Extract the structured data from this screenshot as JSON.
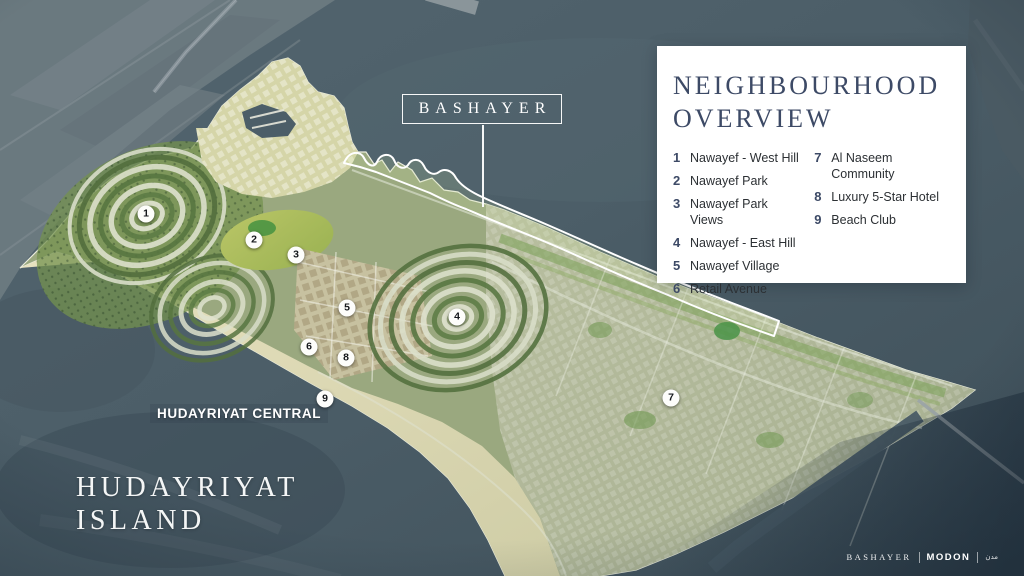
{
  "callout": {
    "label": "BASHAYER"
  },
  "legend": {
    "title_line1": "NEIGHBOURHOOD",
    "title_line2": "OVERVIEW",
    "items_left": [
      {
        "num": "1",
        "label": "Nawayef - West Hill"
      },
      {
        "num": "2",
        "label": "Nawayef Park"
      },
      {
        "num": "3",
        "label": "Nawayef Park Views"
      },
      {
        "num": "4",
        "label": "Nawayef - East Hill"
      },
      {
        "num": "5",
        "label": "Nawayef Village"
      },
      {
        "num": "6",
        "label": "Retail Avenue"
      }
    ],
    "items_right": [
      {
        "num": "7",
        "label": "Al Naseem\nCommunity"
      },
      {
        "num": "8",
        "label": "Luxury 5-Star Hotel"
      },
      {
        "num": "9",
        "label": "Beach Club"
      }
    ]
  },
  "map_labels": {
    "district": "HUDAYRIYAT CENTRAL",
    "island_line1": "HUDAYRIYAT",
    "island_line2": "ISLAND"
  },
  "markers": [
    {
      "num": "1",
      "x": 146,
      "y": 214
    },
    {
      "num": "2",
      "x": 254,
      "y": 240
    },
    {
      "num": "3",
      "x": 296,
      "y": 255
    },
    {
      "num": "4",
      "x": 457,
      "y": 317
    },
    {
      "num": "5",
      "x": 347,
      "y": 308
    },
    {
      "num": "6",
      "x": 309,
      "y": 347
    },
    {
      "num": "7",
      "x": 671,
      "y": 398
    },
    {
      "num": "8",
      "x": 346,
      "y": 358
    },
    {
      "num": "9",
      "x": 325,
      "y": 399
    }
  ],
  "footer": {
    "brand_primary": "BASHAYER",
    "brand_secondary": "MODON",
    "brand_mark": "مدن"
  },
  "colors": {
    "legend_accent": "#3d4a66",
    "legend_text": "#2c3034",
    "panel_bg": "#ffffff",
    "label_white": "#f4f6f6",
    "water": "#4c5e68"
  }
}
